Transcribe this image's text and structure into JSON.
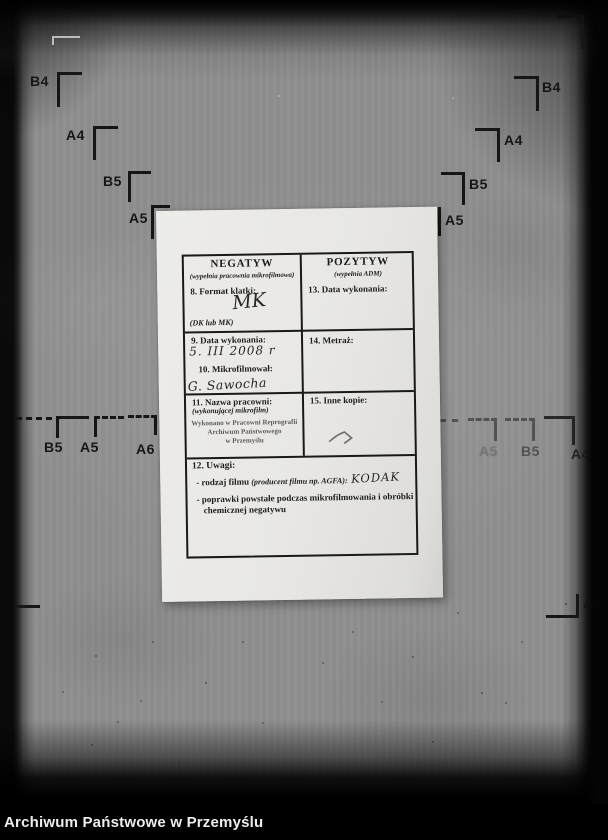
{
  "footer": {
    "title": "Archiwum Państwowe w Przemyślu"
  },
  "marks": {
    "top_left": [
      "B4",
      "A4",
      "B5",
      "A5"
    ],
    "top_right": [
      "B4",
      "A4",
      "B5",
      "A5"
    ],
    "top_right_partial": "A",
    "mid_left": [
      "B5",
      "A5",
      "A6"
    ],
    "mid_right": [
      "A5",
      "B5",
      "A4"
    ],
    "bottom_right": "A4"
  },
  "form": {
    "negatyw": {
      "title": "NEGATYW",
      "subtitle": "(wypełnia pracownia mikrofilmowa)"
    },
    "pozytyw": {
      "title": "POZYTYW",
      "subtitle": "(wypełnia ADM)"
    },
    "f8": {
      "label": "8. Format klatki:",
      "value": "MK",
      "hint": "(DK lub MK)"
    },
    "f13": {
      "label": "13. Data wykonania:"
    },
    "f9": {
      "label": "9. Data wykonania:",
      "value": "5. III 2008 r"
    },
    "f10": {
      "label": "10. Mikrofilmował:",
      "value": "G. Sawocha"
    },
    "f14": {
      "label": "14. Metraż:"
    },
    "f11": {
      "label": "11. Nazwa pracowni:",
      "subtitle": "(wykonującej mikrofilm)",
      "stamp": [
        "Wykonano w Pracowni Reprografii",
        "Archiwum Państwowego",
        "w Przemyślu"
      ]
    },
    "f15": {
      "label": "15. Inne kopie:"
    },
    "f12": {
      "label": "12. Uwagi:",
      "item1_text": "- rodzaj filmu ",
      "item1_note": "(producent filmu np. AGFA):",
      "item1_value": "KODAK",
      "item2_line1": "- poprawki powstałe podczas mikrofilmowania i obróbki",
      "item2_line2": "chemicznej negatywu"
    }
  },
  "colors": {
    "film_bg": "#8f8f8f",
    "paper": "#e8e7e4",
    "ink": "#1c1c1c",
    "stamp_ink": "#5d5d5d",
    "footer_bg": "#000000",
    "footer_text": "#ededed"
  }
}
